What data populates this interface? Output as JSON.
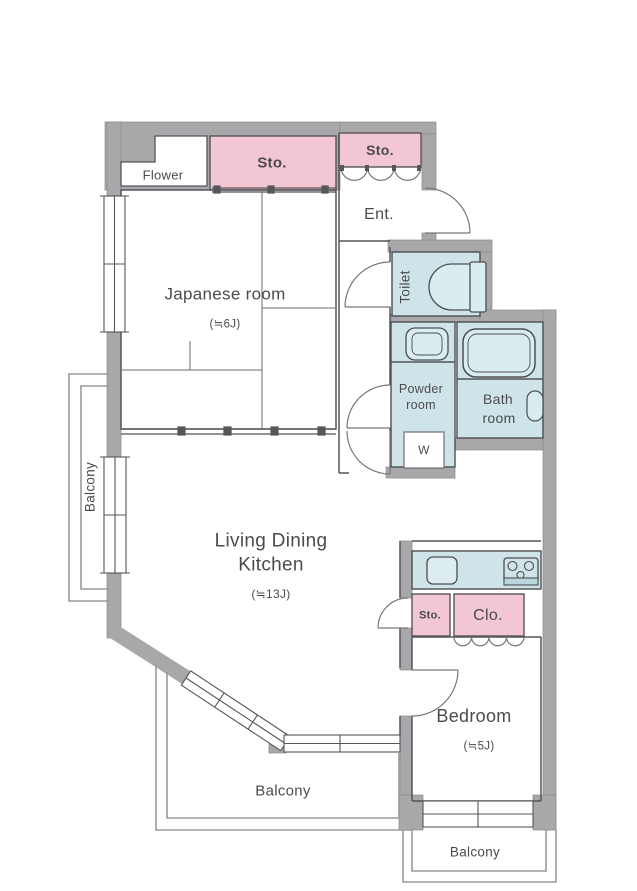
{
  "title": "Apartment floor plan (1LDK+ layout)",
  "colors": {
    "wall_gray": "#a8a8ab",
    "storage_pink": "#f2c6d3",
    "wet_area_blue": "#cfe4e9",
    "outline_dark": "#55555a",
    "balcony_rail_gray": "#9a9a9e",
    "text_gray": "#4b4b4e"
  },
  "rooms": {
    "flower": {
      "label": "Flower"
    },
    "storage_top": {
      "label": "Sto."
    },
    "storage_entrance": {
      "label": "Sto."
    },
    "entrance": {
      "label": "Ent."
    },
    "japanese_room": {
      "label": "Japanese room",
      "size": "(≒6J)"
    },
    "toilet": {
      "label": "Toilet"
    },
    "powder_room": {
      "label_line1": "Powder",
      "label_line2": "room"
    },
    "bath_room": {
      "label_line1": "Bath",
      "label_line2": "room"
    },
    "washer": {
      "label": "W"
    },
    "ldk": {
      "label_line1": "Living Dining",
      "label_line2": "Kitchen",
      "size": "(≒13J)"
    },
    "storage_kitchen": {
      "label": "Sto."
    },
    "closet": {
      "label": "Clo."
    },
    "bedroom": {
      "label": "Bedroom",
      "size": "(≒5J)"
    },
    "balcony_left": {
      "label": "Balcony"
    },
    "balcony_bottom": {
      "label": "Balcony"
    },
    "balcony_bottom_right": {
      "label": "Balcony"
    }
  }
}
